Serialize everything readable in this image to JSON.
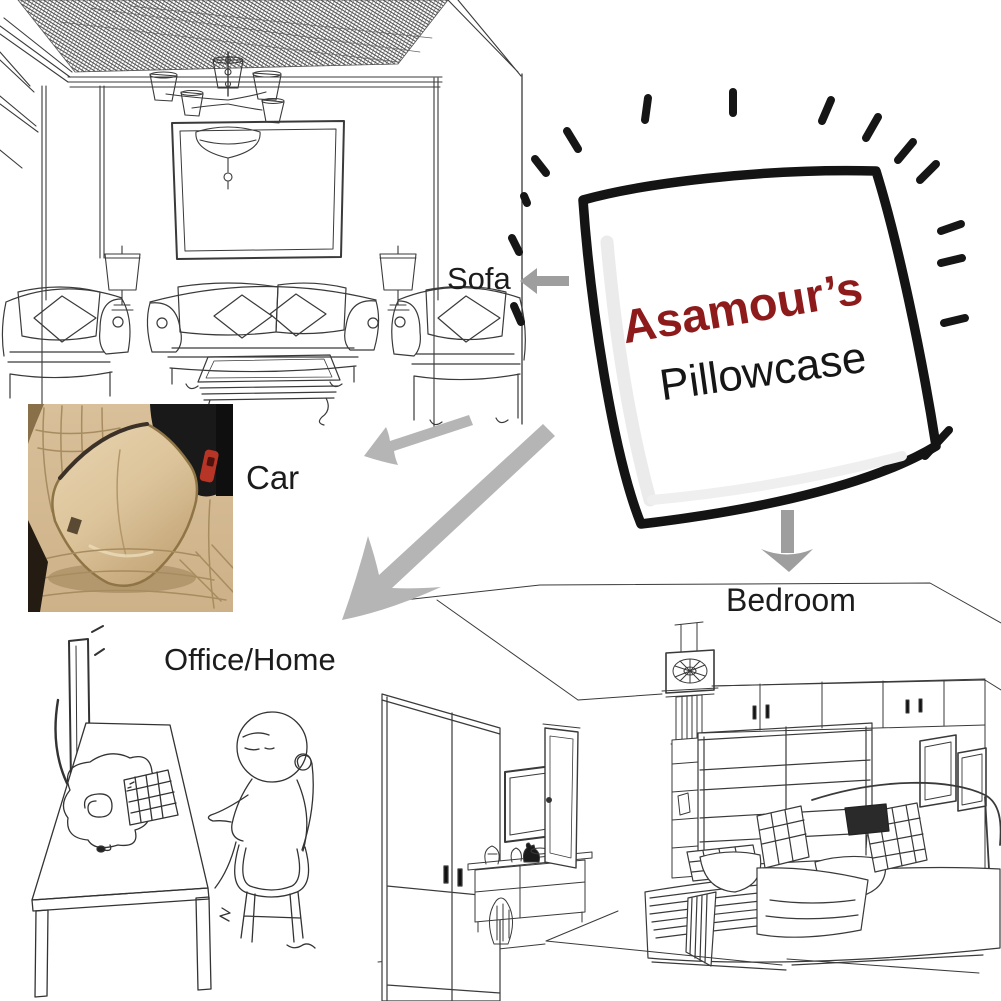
{
  "page": {
    "width": 1001,
    "height": 1001,
    "background": "#ffffff",
    "kind": "product-usage-infographic"
  },
  "pillow": {
    "brand": "Asamour’s",
    "product": "Pillowcase"
  },
  "scenes": [
    {
      "id": "sofa",
      "label": "Sofa",
      "illustration": "living-room-line-art"
    },
    {
      "id": "car",
      "label": "Car",
      "illustration": "car-seat-photo"
    },
    {
      "id": "office",
      "label": "Office/Home",
      "illustration": "desk-cartoon-line-art"
    },
    {
      "id": "bedroom",
      "label": "Bedroom",
      "illustration": "bedroom-line-art"
    }
  ],
  "icons": {
    "pillow_glow": "radiating-dashes",
    "sofa_arrow": "arrow-left",
    "car_arrow": "arrow-down-left",
    "office_arrow": "arrow-down-left-large",
    "bedroom_arrow": "arrow-down"
  },
  "colors": {
    "brand_red": "#8e1b1b",
    "ink": "#1c1c1c",
    "line": "#333333",
    "arrow_gray": "#b5b5b5",
    "arrow_gray_dark": "#9e9e9e",
    "cushion_beige": "#d7bd95",
    "cushion_beige_light": "#e6d2ad",
    "cushion_beige_dark": "#c0a274",
    "cushion_trim": "#8f7446",
    "car_interior_black": "#191919",
    "seatbelt_red": "#b73527"
  }
}
